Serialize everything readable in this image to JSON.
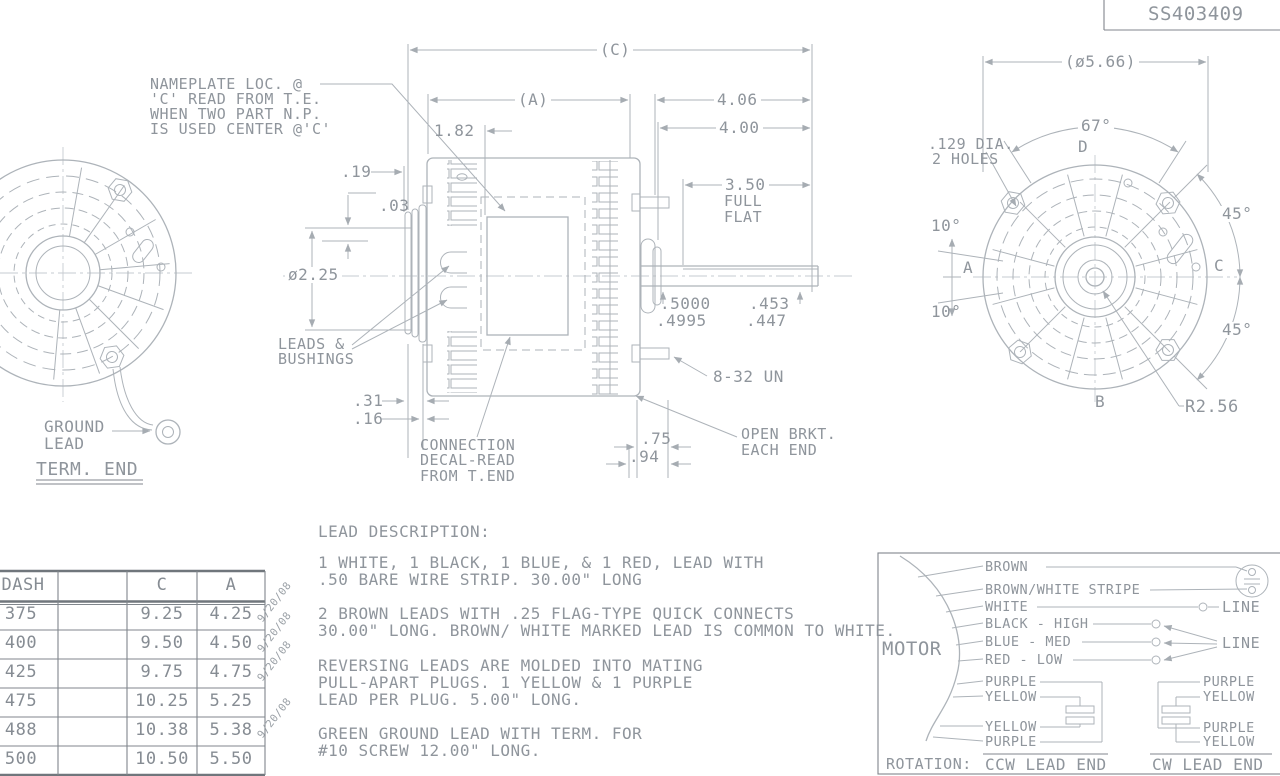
{
  "title_block": {
    "part_number": "SS403409"
  },
  "term_end_view": {
    "ground_lead_line1": "GROUND",
    "ground_lead_line2": "LEAD",
    "caption": "TERM. END"
  },
  "side_view": {
    "nameplate_note_line1": "NAMEPLATE LOC. @",
    "nameplate_note_line2": "'C' READ FROM T.E.",
    "nameplate_note_line3": "WHEN TWO PART N.P.",
    "nameplate_note_line4": "IS USED CENTER @'C'",
    "dim_c": "(C)",
    "dim_a": "(A)",
    "dim_182": "1.82",
    "dim_19": ".19",
    "dim_03": ".03",
    "dim_hub_dia": "ø2.25",
    "dim_406": "4.06",
    "dim_400": "4.00",
    "dim_350": "3.50",
    "dim_350_l2": "FULL",
    "dim_350_l3": "FLAT",
    "shaft_dia_upper": ".5000",
    "shaft_dia_lower": ".4995",
    "shaft_flat_upper": ".453",
    "shaft_flat_lower": ".447",
    "stud_thread": "8-32 UN",
    "dim_31": ".31",
    "dim_16": ".16",
    "dim_75": ".75",
    "dim_94": ".94",
    "leads_label_line1": "LEADS &",
    "leads_label_line2": "BUSHINGS",
    "bracket_note_line1": "OPEN BRKT.",
    "bracket_note_line2": "EACH END",
    "decal_note_line1": "CONNECTION",
    "decal_note_line2": "DECAL-READ",
    "decal_note_line3": "FROM T.END"
  },
  "shaft_end_view": {
    "dim_dia": "(ø5.66)",
    "dim_67": "67°",
    "holes_note_line1": ".129 DIA.",
    "holes_note_line2": "2 HOLES",
    "dim_10_top": "10°",
    "dim_10_bottom": "10°",
    "dim_45_top": "45°",
    "dim_45_bottom": "45°",
    "dim_radius": "R2.56",
    "point_a": "A",
    "point_b": "B",
    "point_c": "C",
    "point_d": "D"
  },
  "dash_table": {
    "col_dash": "DASH",
    "col_blank": "",
    "col_c": "C",
    "col_a": "A",
    "rows": [
      {
        "dash": "375",
        "c": "9.25",
        "a": "4.25"
      },
      {
        "dash": "400",
        "c": "9.50",
        "a": "4.50"
      },
      {
        "dash": "425",
        "c": "9.75",
        "a": "4.75"
      },
      {
        "dash": "475",
        "c": "10.25",
        "a": "5.25"
      },
      {
        "dash": "488",
        "c": "10.38",
        "a": "5.38"
      },
      {
        "dash": "500",
        "c": "10.50",
        "a": "5.50"
      }
    ],
    "stamp": "9/20/08"
  },
  "lead_description": {
    "title": "LEAD DESCRIPTION:",
    "p1_line1": "1 WHITE, 1 BLACK, 1 BLUE, & 1 RED, LEAD WITH",
    "p1_line2": ".50 BARE WIRE STRIP. 30.00\" LONG",
    "p2_line1": "2 BROWN LEADS WITH .25 FLAG-TYPE QUICK CONNECTS",
    "p2_line2": "30.00\" LONG. BROWN/ WHITE MARKED LEAD IS COMMON TO WHITE.",
    "p3_line1": "REVERSING LEADS ARE MOLDED INTO MATING",
    "p3_line2": "PULL-APART PLUGS. 1 YELLOW & 1 PURPLE",
    "p3_line3": "LEAD PER PLUG. 5.00\" LONG.",
    "p4_line1": "GREEN GROUND LEAD WITH TERM. FOR",
    "p4_line2": "#10 SCREW 12.00\" LONG."
  },
  "wiring_diagram": {
    "motor_label": "MOTOR",
    "lead_brown": "BROWN",
    "lead_brown_white": "BROWN/WHITE STRIPE",
    "lead_white": "WHITE",
    "lead_black": "BLACK - HIGH",
    "lead_blue": "BLUE - MED",
    "lead_red": "RED - LOW",
    "line_label_top": "LINE",
    "line_label_bottom": "LINE",
    "ccw_lead_1": "PURPLE",
    "ccw_lead_2": "YELLOW",
    "ccw_lead_3": "YELLOW",
    "ccw_lead_4": "PURPLE",
    "cw_lead_1": "PURPLE",
    "cw_lead_2": "YELLOW",
    "cw_lead_3": "PURPLE",
    "cw_lead_4": "YELLOW",
    "rotation_label": "ROTATION:",
    "ccw_caption": "CCW LEAD END",
    "cw_caption": "CW LEAD END"
  },
  "colors": {
    "line": "#adb3b9",
    "text": "#8f959c",
    "heavy_line": "#70767c"
  }
}
